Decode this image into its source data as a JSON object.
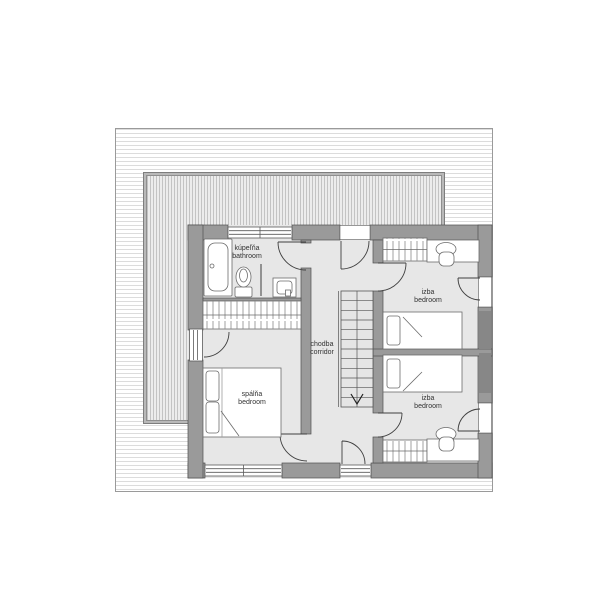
{
  "rooms": [
    {
      "id": "bathroom",
      "label_primary": "kúpeľňa",
      "label_secondary": "bathroom"
    },
    {
      "id": "corridor",
      "label_primary": "chodba",
      "label_secondary": "corridor"
    },
    {
      "id": "bedroom-master",
      "label_primary": "spálňa",
      "label_secondary": "bedroom"
    },
    {
      "id": "bedroom-top",
      "label_primary": "izba",
      "label_secondary": "bedroom"
    },
    {
      "id": "bedroom-bottom",
      "label_primary": "izba",
      "label_secondary": "bedroom"
    }
  ],
  "furniture_icons": [
    "bathtub-icon",
    "toilet-icon",
    "sink-icon",
    "wardrobe-icon",
    "double-bed-icon",
    "single-bed-icon",
    "desk-icon",
    "chair-icon",
    "staircase-icon",
    "stair-direction-arrow-icon"
  ],
  "stairs": {
    "direction": "down"
  },
  "colors": {
    "wall_fill": "#9a9a9a",
    "wall_dark": "#878787",
    "floor_fill": "#e7e7e7",
    "outline": "#4a4a4a",
    "roof_hatch": "#c3c3c3",
    "site_hatch": "#dcdcdc",
    "furniture_fill": "#ffffff"
  }
}
